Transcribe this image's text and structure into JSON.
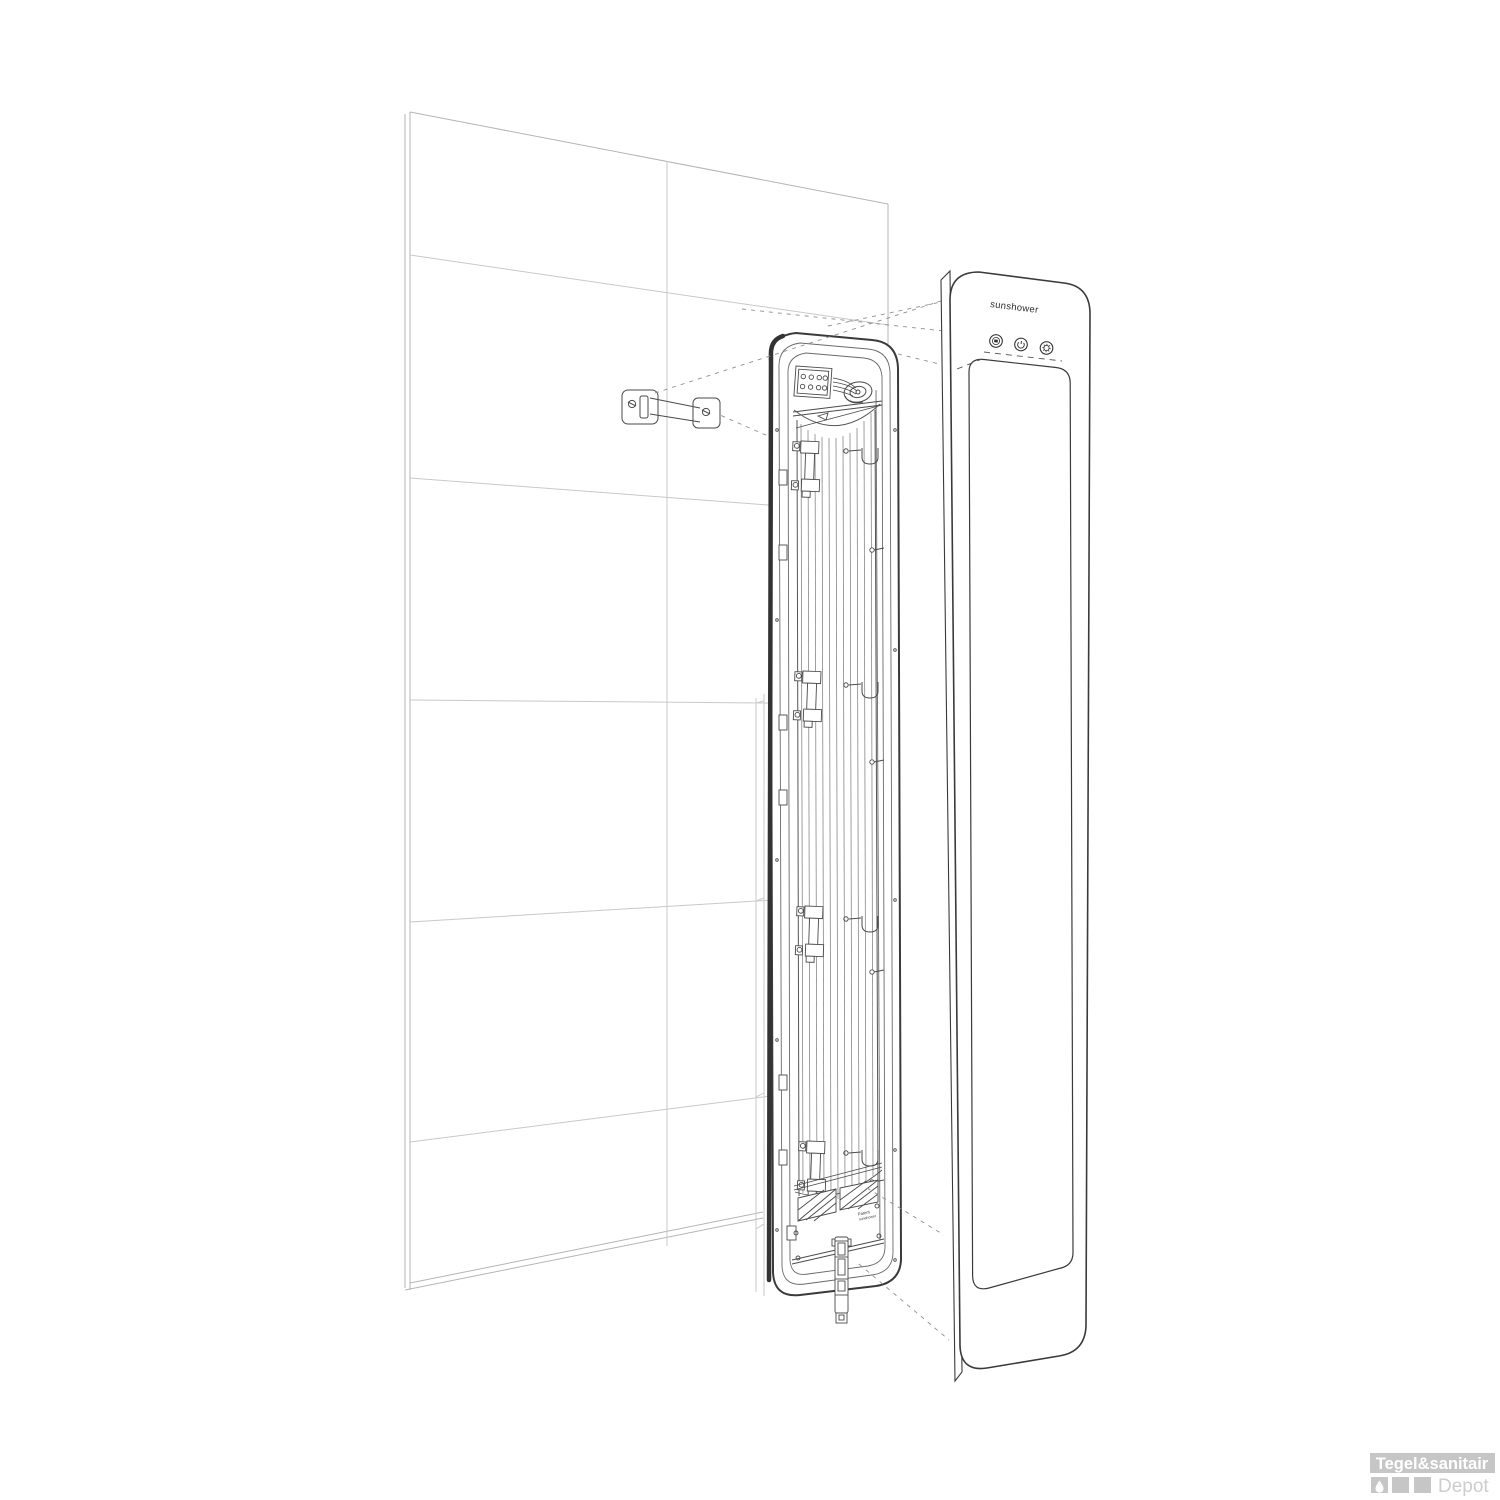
{
  "illustration": {
    "brand_wordmark": "sunshower",
    "control_buttons": [
      {
        "name": "display-button",
        "icon": "display-icon"
      },
      {
        "name": "power-button",
        "icon": "power-icon"
      },
      {
        "name": "settings-button",
        "icon": "gear-icon"
      }
    ],
    "patent_label": {
      "line1": "Patent",
      "line2": "sunshower"
    },
    "colors": {
      "unit_line": "#3a3a3a",
      "detail_line": "#555555",
      "tile_line": "#c9c9c9",
      "leader_line": "#8f8f8f"
    }
  },
  "watermark": {
    "title": "Tegel&sanitair",
    "subtitle": "Depot",
    "icon": "water-drop-icon",
    "block_color": "#c6c6c6",
    "title_color": "#ffffff",
    "subtitle_color": "#cdcdcd"
  }
}
